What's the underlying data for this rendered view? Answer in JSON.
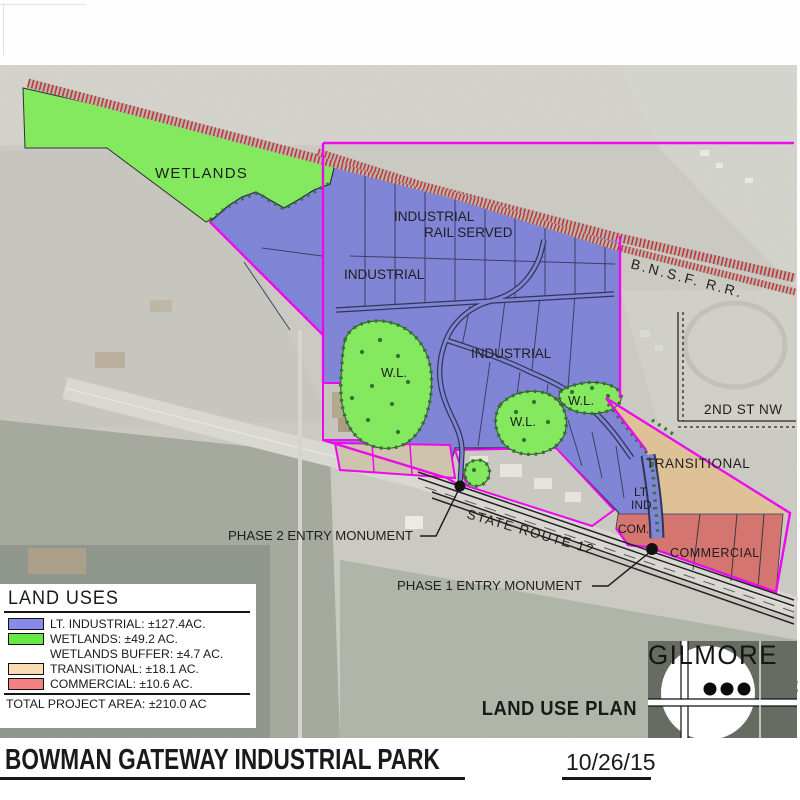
{
  "title_block": {
    "project_title": "BOWMAN GATEWAY INDUSTRIAL PARK",
    "date": "10/26/15",
    "plan_title": "LAND USE PLAN"
  },
  "legend": {
    "title": "LAND USES",
    "rows": [
      {
        "label": "LT. INDUSTRIAL: ±127.4AC.",
        "color": "#8a8ae8"
      },
      {
        "label": "WETLANDS: ±49.2 AC.",
        "color": "#66e945"
      },
      {
        "label": "WETLANDS BUFFER: ±4.7 AC.",
        "color": null
      },
      {
        "label": "TRANSITIONAL: ±18.1 AC.",
        "color": "#f8dcb4"
      },
      {
        "label": "COMMERCIAL: ±10.6 AC.",
        "color": "#f28181"
      }
    ],
    "total": "TOTAL PROJECT AREA: ±210.0 AC"
  },
  "map_labels": {
    "wetlands": "WETLANDS",
    "industrial_a": "INDUSTRIAL",
    "rail_served": "RAIL SERVED",
    "industrial_b": "INDUSTRIAL",
    "industrial_c": "INDUSTRIAL",
    "wl_a": "W.L.",
    "wl_b": "W.L.",
    "wl_c": "W.L.",
    "transitional": "TRANSITIONAL",
    "lt_ind_line1": "LT.",
    "lt_ind_line2": "IND.",
    "com": "COM.",
    "commercial": "COMMERCIAL",
    "bnsf_rr": "B.N.S.F. R.R.",
    "second_st_nw": "2ND ST NW",
    "state_route_12": "STATE ROUTE 12",
    "phase2_monument": "PHASE 2 ENTRY MONUMENT",
    "phase1_monument": "PHASE 1 ENTRY MONUMENT"
  },
  "branding": {
    "name": "GILMORE",
    "tagline": "PLANNING & LANDSCAPE ARCHITECTURE",
    "address1": "2211 N. 7th Street",
    "address2": "Phoenix, Az 85006",
    "phone": "T  602.266.5622",
    "website": "www.gplgilmore.com"
  },
  "colors": {
    "lt_industrial": "#7d81d6",
    "wetlands": "#80e95a",
    "transitional": "#dec094",
    "commercial": "#d4716c",
    "boundary": "#ee00ee",
    "railroad": "#c13030",
    "road": "#27304f"
  }
}
